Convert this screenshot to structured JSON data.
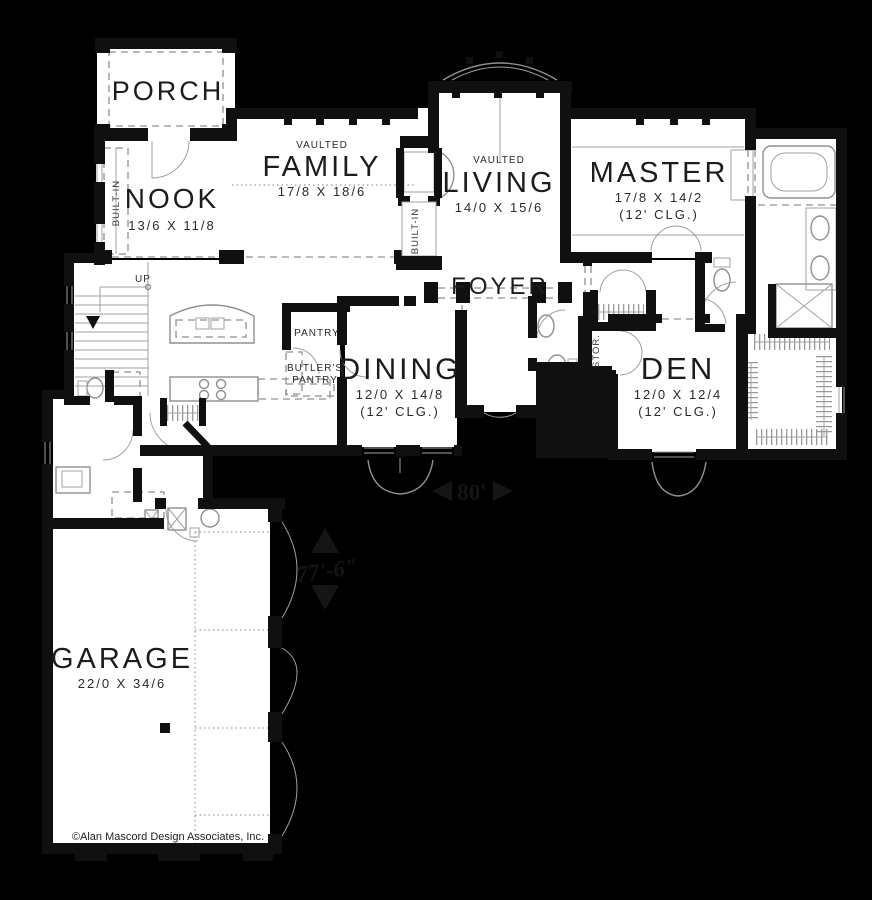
{
  "rooms": {
    "porch": {
      "name": "PORCH"
    },
    "nook": {
      "name": "NOOK",
      "dims": "13/6 X 11/8"
    },
    "family": {
      "vaulted": "VAULTED",
      "name": "FAMILY",
      "dims": "17/8 X 18/6"
    },
    "living": {
      "vaulted": "VAULTED",
      "name": "LIVING",
      "dims": "14/0 X 15/6"
    },
    "master": {
      "name": "MASTER",
      "dims": "17/8 X 14/2",
      "ceiling": "(12' CLG.)"
    },
    "foyer": {
      "name": "FOYER"
    },
    "dining": {
      "name": "DINING",
      "dims": "12/0 X 14/8",
      "ceiling": "(12' CLG.)"
    },
    "den": {
      "name": "DEN",
      "dims": "12/0 X 12/4",
      "ceiling": "(12' CLG.)"
    },
    "garage": {
      "name": "GARAGE",
      "dims": "22/0 X 34/6"
    },
    "pantry": {
      "name": "PANTRY"
    },
    "butlers": {
      "line1": "BUTLER'S",
      "line2": "PANTRY"
    },
    "storage": {
      "name": "STOR."
    }
  },
  "labels": {
    "up": "UP",
    "built_in": "BUILT-IN",
    "dim_width": "80'",
    "dim_depth": "77'-6\""
  },
  "copyright": "©Alan Mascord Design Associates, Inc."
}
